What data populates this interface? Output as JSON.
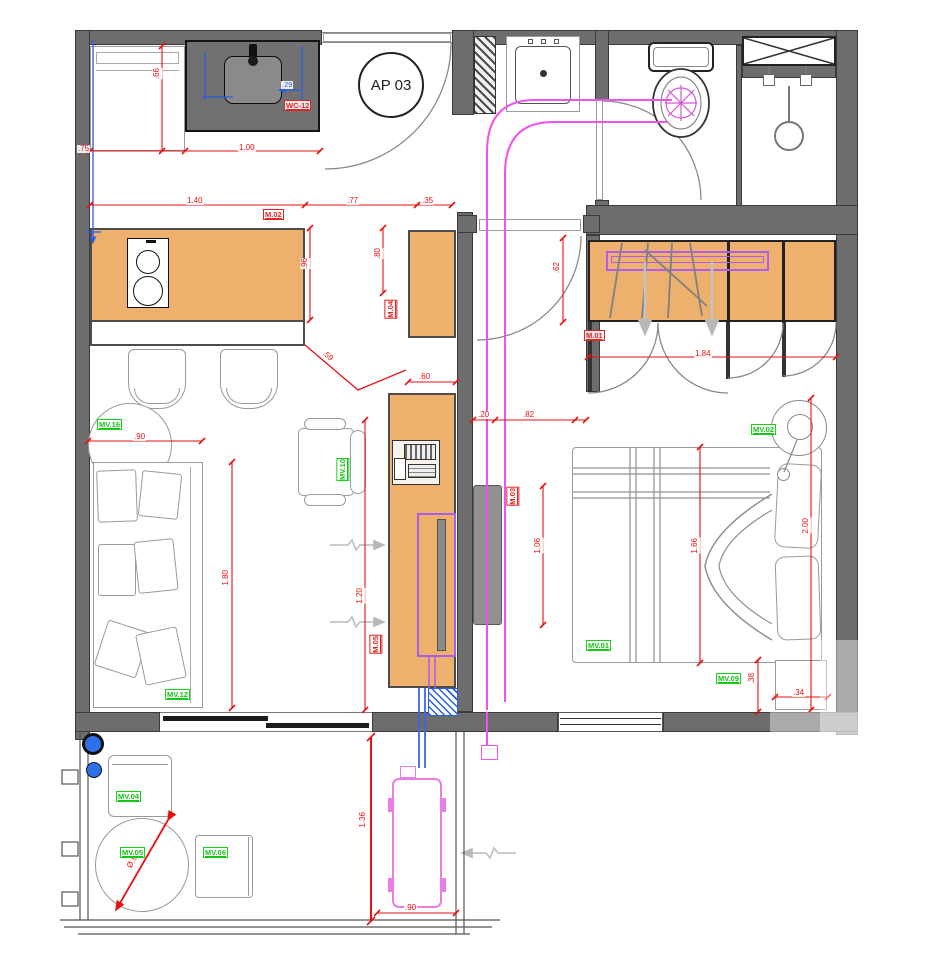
{
  "title": "AP 03",
  "colors": {
    "wall": "#6d6d6d",
    "furniture_fill": "#eeb06d",
    "dimension_red": "#e81010",
    "label_green": "#17d317",
    "pipe_magenta": "#f052f0",
    "tv_purple": "#a85cf0",
    "pipe_blue": "#3a66e8",
    "counter_dark": "#717171"
  },
  "red_labels": {
    "sink": "WC-12",
    "island": "M.02",
    "cabinet": "M.04",
    "tv_unit": "M.05",
    "hall_panel": "M.03",
    "wardrobe": "M.01"
  },
  "green_labels": {
    "side_table": "MV.16",
    "sofa": "MV.12",
    "chair": "MV.10",
    "bed": "MV.01",
    "lamp": "MV.02",
    "nightstand": "MV.09",
    "balcony_chair": "MV.04",
    "balcony_table": "MV.05",
    "balcony_seat": "MV.06"
  },
  "dimensions": {
    "fridge_w": ".75",
    "counter_w": "1.00",
    "sink_offset": ".29",
    "fridge_d": ".66",
    "island_w": "1.40",
    "island_gap": ".77",
    "cabinet_offset": ".35",
    "island_d": ".96",
    "cabinet_w": ".80",
    "cabinet2_w": ".60",
    "diag_gap": ".59",
    "closet_side": ".62",
    "closet_w": "1.84",
    "door_a": ".20",
    "door_b": ".82",
    "panel_h": "1.06",
    "bed_l": "1.66",
    "room_d": "2.00",
    "nightstand_d": ".38",
    "nightstand_w": ".34",
    "sofa_w": ".90",
    "sofa_l": "1.80",
    "tv_dist": "1.20",
    "balcony_d": "1.36",
    "ac_w": ".90",
    "table_dia": "Ø.90"
  }
}
